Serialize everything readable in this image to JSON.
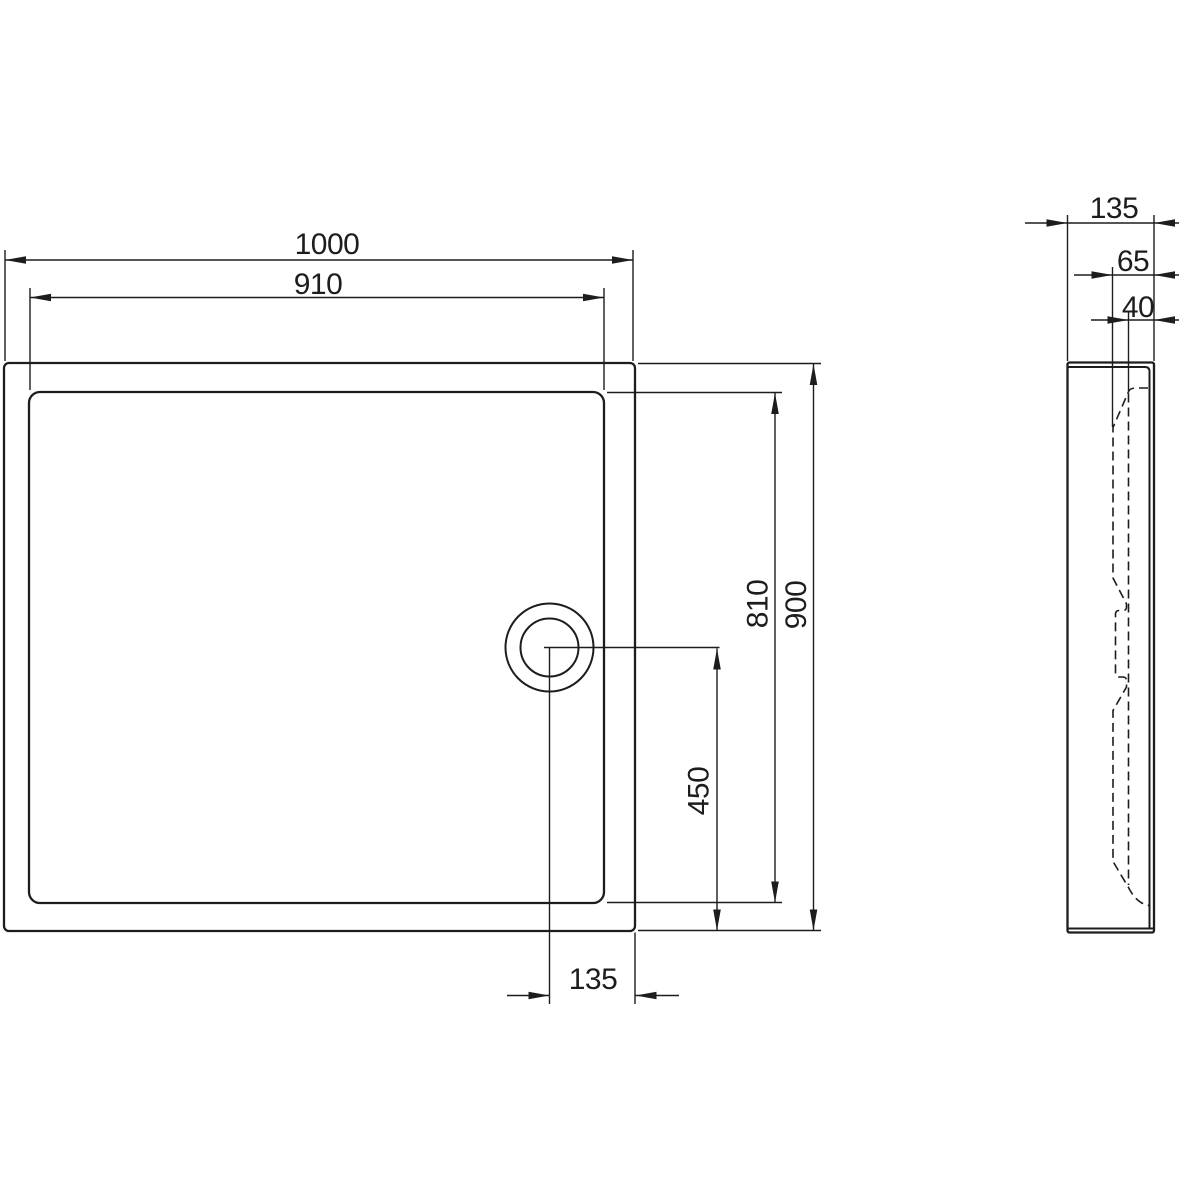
{
  "labels": {
    "plan": {
      "outer_width": "1000",
      "inner_width": "910",
      "outer_height": "900",
      "inner_height": "810",
      "drain_from_bottom": "450",
      "drain_from_right_edge": "135"
    },
    "side": {
      "depth": "135",
      "rim_offset": "65",
      "wall_offset": "40"
    }
  },
  "colors": {
    "line": "#1d1d1b",
    "background": "#ffffff"
  }
}
